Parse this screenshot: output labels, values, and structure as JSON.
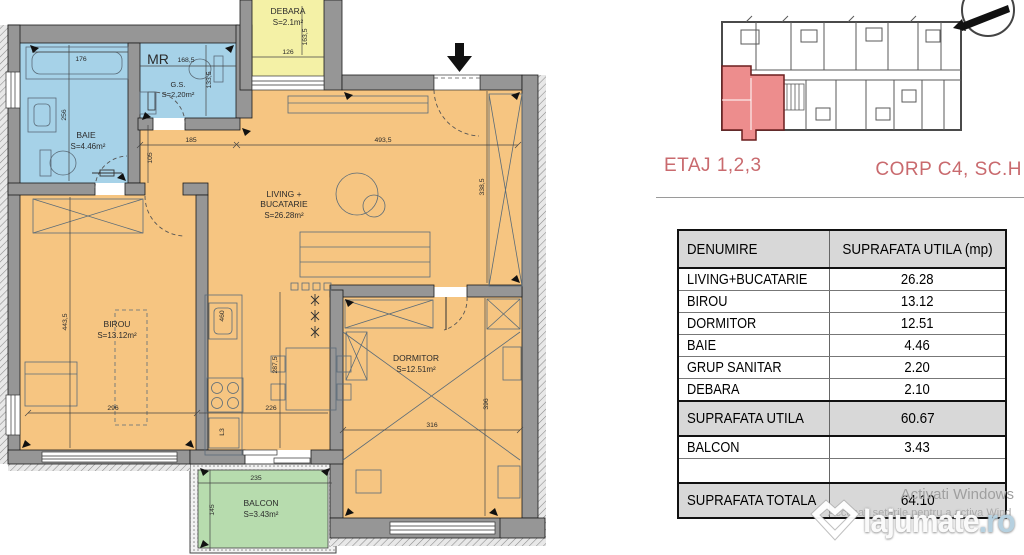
{
  "plan": {
    "rooms": {
      "baie": {
        "name": "BAIE",
        "area": "S=4.46m²"
      },
      "gs": {
        "tag": "MR",
        "name": "G.S.",
        "area": "S=2,20m²"
      },
      "debara": {
        "name": "DEBARA",
        "area": "S=2.1m²"
      },
      "living": {
        "line1": "LIVING +",
        "line2": "BUCATARIE",
        "area": "S=26.28m²"
      },
      "birou": {
        "name": "BIROU",
        "area": "S=13.12m²"
      },
      "dormitor": {
        "name": "DORMITOR",
        "area": "S=12.51m²"
      },
      "balcon": {
        "name": "BALCON",
        "area": "S=3.43m²"
      }
    },
    "dims": {
      "baie_w": "176",
      "baie_h": "256",
      "gs_w": "168,5",
      "gs_h": "133,5",
      "debara_w": "126",
      "debara_h": "163,5",
      "hall_w": "185",
      "hall_h": "105",
      "living_w": "493,5",
      "living_h": "338,5",
      "birou_h": "443,5",
      "birou_w": "296",
      "kitchen_len": "460",
      "kitchen_w": "226",
      "kitchen_h": "287,5",
      "fridge": "L3",
      "dormitor_w": "316",
      "dormitor_h": "396",
      "balcon_w": "235",
      "balcon_h": "145"
    }
  },
  "overview": {
    "etaj": "ETAJ 1,2,3",
    "corp": "CORP C4, SC.H",
    "accent": "#c96a6e",
    "highlight": "#ed8d8d"
  },
  "table": {
    "header": [
      "DENUMIRE",
      "SUPRAFATA UTILA (mp)"
    ],
    "rows": [
      {
        "label": "LIVING+BUCATARIE",
        "value": "26.28"
      },
      {
        "label": "BIROU",
        "value": "13.12"
      },
      {
        "label": "DORMITOR",
        "value": "12.51"
      },
      {
        "label": "BAIE",
        "value": "4.46"
      },
      {
        "label": "GRUP SANITAR",
        "value": "2.20"
      },
      {
        "label": "DEBARA",
        "value": "2.10"
      }
    ],
    "subtotal": {
      "label": "SUPRAFATA UTILA",
      "value": "60.67"
    },
    "balcon": {
      "label": "BALCON",
      "value": "3.43"
    },
    "total": {
      "label": "SUPRAFATA TOTALA",
      "value": "64.10"
    }
  },
  "watermark": {
    "line1": "Activati Windows",
    "line2": "Accesați setările pentru a activa Wind",
    "logo_main": "lajumate",
    "logo_tld": ".ro"
  }
}
